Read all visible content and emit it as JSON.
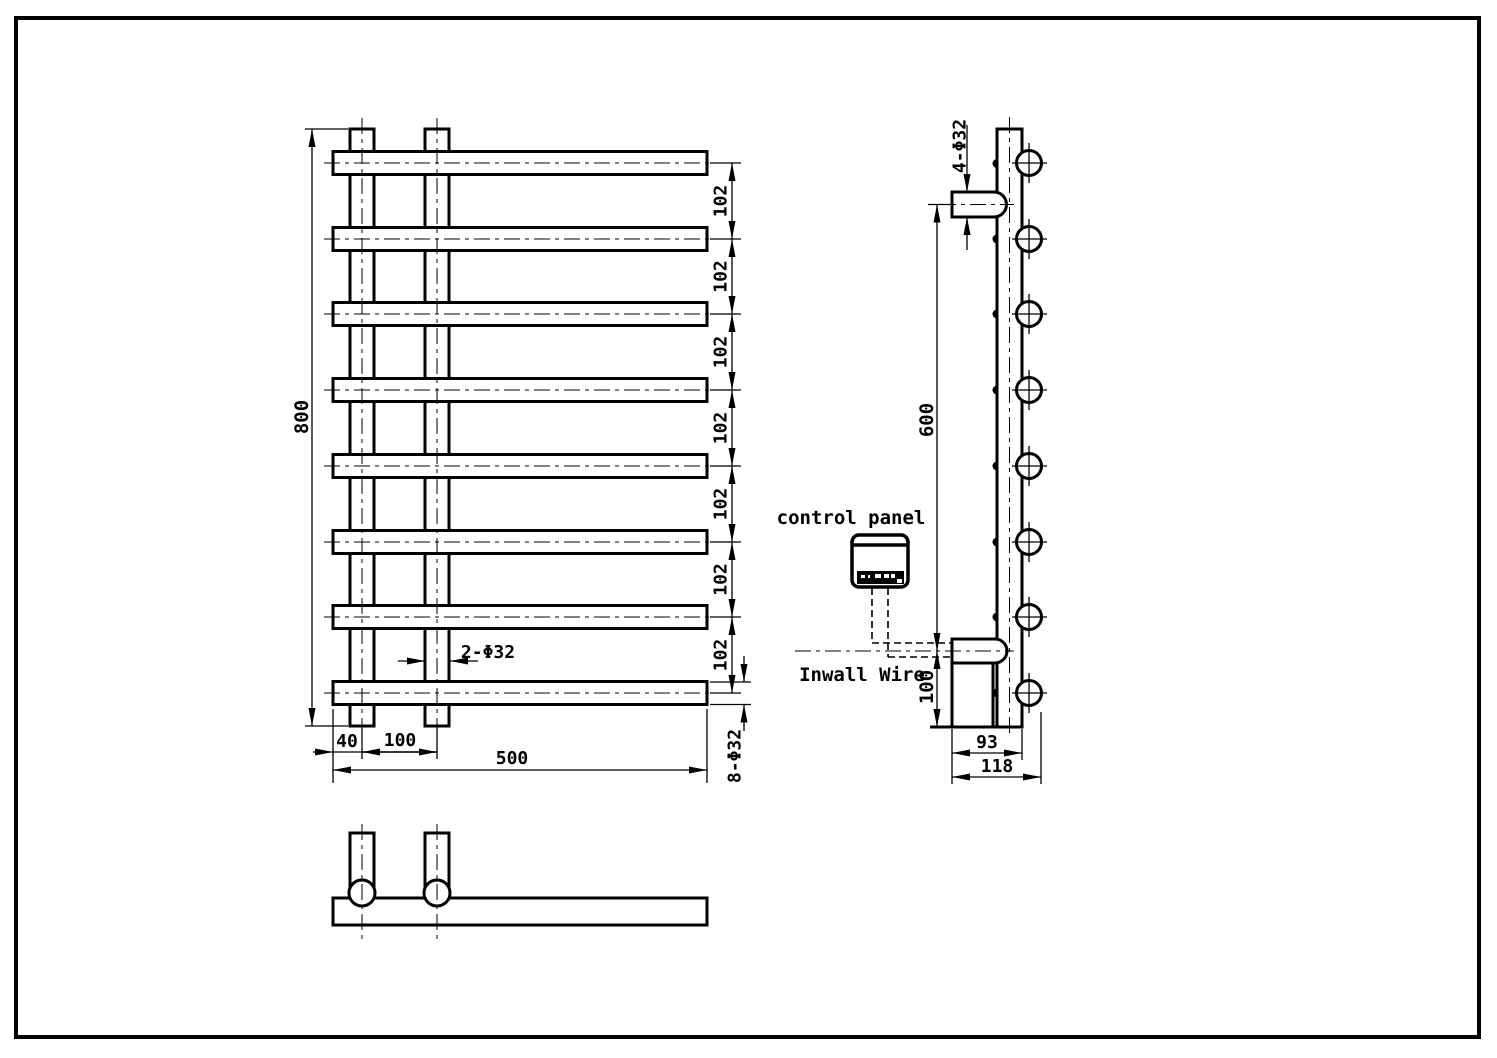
{
  "drawing": {
    "front_view": {
      "overall_height": "800",
      "bar_spacings": [
        "102",
        "102",
        "102",
        "102",
        "102",
        "102",
        "102"
      ],
      "post_dia_label": "2-Φ32",
      "left_offset": "40",
      "post_spacing": "100",
      "overall_width": "500",
      "bar_dia_label": "8-Φ32"
    },
    "side_view": {
      "bracket_dia_label": "4-Φ32",
      "bracket_span": "600",
      "bottom_offset": "100",
      "bracket_depth": "93",
      "overall_depth": "118",
      "control_panel_label": "control panel",
      "inwall_wire_label": "Inwall Wire"
    }
  }
}
